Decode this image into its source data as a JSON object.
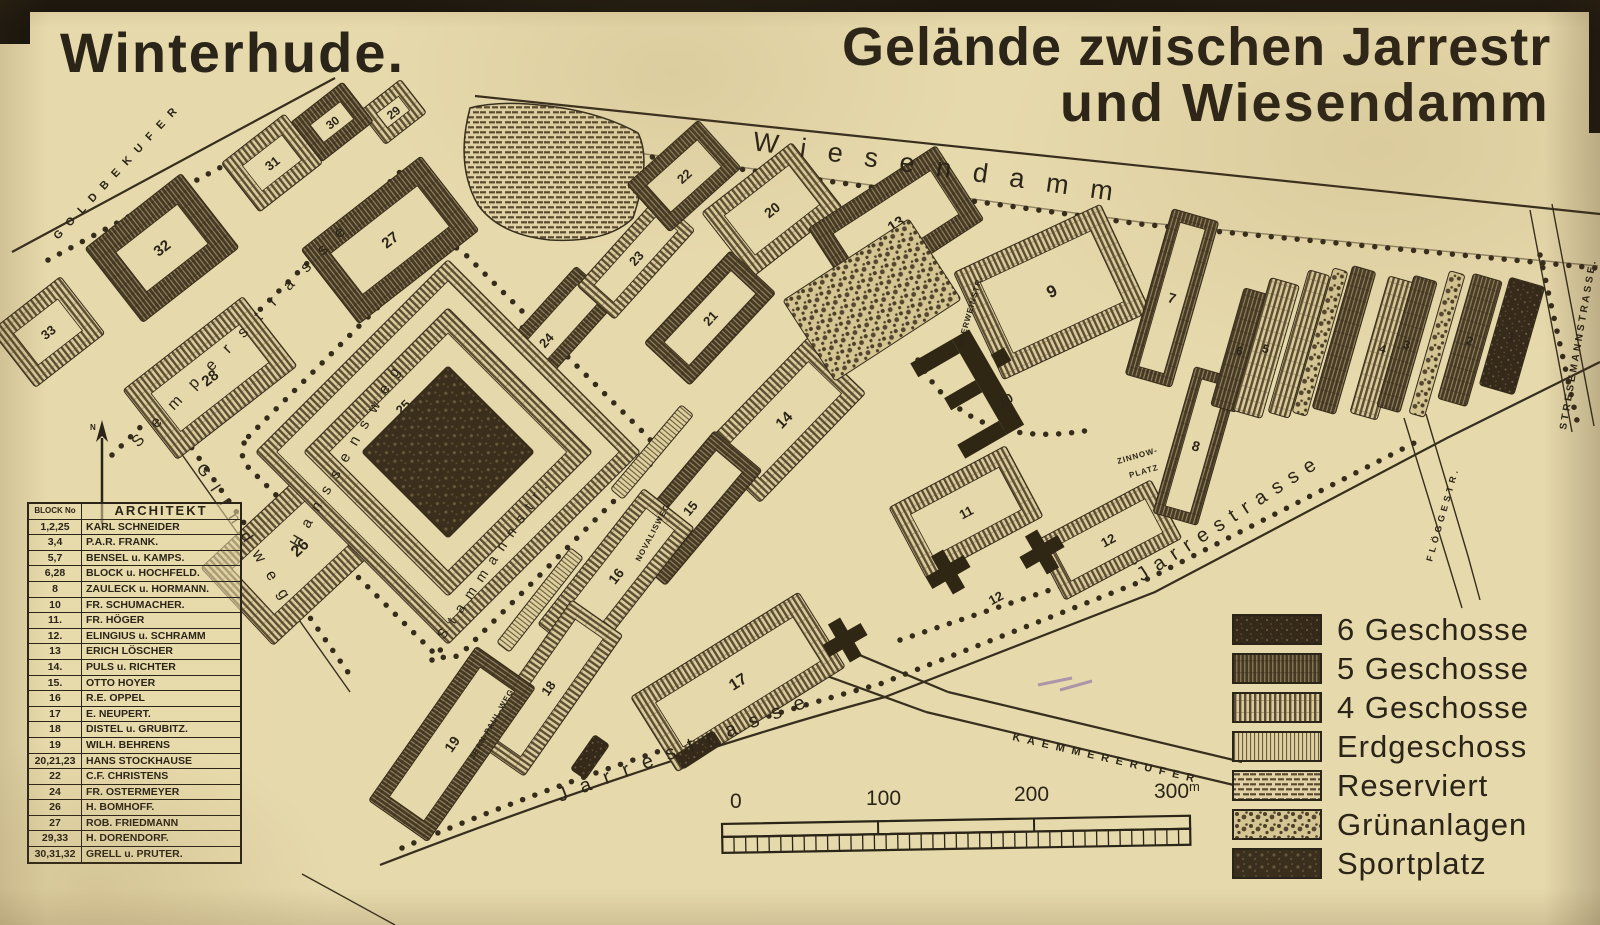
{
  "titles": {
    "left": "Winterhude.",
    "right_line1": "Gelände zwischen Jarrestr",
    "right_line2": "und Wiesendamm"
  },
  "architects": {
    "header_block": "BLOCK No",
    "header_architekt": "ARCHITEKT",
    "rows": [
      [
        "1,2,25",
        "KARL SCHNEIDER"
      ],
      [
        "3,4",
        "P.A.R. FRANK."
      ],
      [
        "5,7",
        "BENSEL u. KAMPS."
      ],
      [
        "6,28",
        "BLOCK u. HOCHFELD."
      ],
      [
        "8",
        "ZAULECK u. HORMANN."
      ],
      [
        "10",
        "FR. SCHUMACHER."
      ],
      [
        "11.",
        "FR. HÖGER"
      ],
      [
        "12.",
        "ELINGIUS u. SCHRAMM"
      ],
      [
        "13",
        "ERICH LÖSCHER"
      ],
      [
        "14.",
        "PULS u. RICHTER"
      ],
      [
        "15.",
        "OTTO HOYER"
      ],
      [
        "16",
        "R.E. OPPEL"
      ],
      [
        "17",
        "E. NEUPERT."
      ],
      [
        "18",
        "DISTEL u. GRUBITZ."
      ],
      [
        "19",
        "WILH. BEHRENS"
      ],
      [
        "20,21,23",
        "HANS STOCKHAUSE"
      ],
      [
        "22",
        "C.F. CHRISTENS"
      ],
      [
        "24",
        "FR. OSTERMEYER"
      ],
      [
        "26",
        "H. BOMHOFF."
      ],
      [
        "27",
        "ROB. FRIEDMANN"
      ],
      [
        "29,33",
        "H. DORENDORF."
      ],
      [
        "30,31,32",
        "GRELL u. PRUTER."
      ]
    ]
  },
  "legend": {
    "items": [
      {
        "label": "6 Geschosse",
        "pattern": "p6"
      },
      {
        "label": "5 Geschosse",
        "pattern": "p5"
      },
      {
        "label": "4 Geschosse",
        "pattern": "p4"
      },
      {
        "label": "Erdgeschoss",
        "pattern": "peg"
      },
      {
        "label": "Reserviert",
        "pattern": "pres"
      },
      {
        "label": "Grünanlagen",
        "pattern": "pgruen"
      },
      {
        "label": "Sportplatz",
        "pattern": "psport"
      }
    ]
  },
  "scale": {
    "labels": [
      "0",
      "100",
      "200",
      "300"
    ],
    "unit": "m"
  },
  "map": {
    "north_label": "N",
    "streets": {
      "wiesendamm": "Wiesendamm",
      "jarrestrasse": "Jarrestrasse",
      "semperstrasse": "Semperstrasse",
      "hanssensweg": "Hanssensweg",
      "glindweg": "Glindweg",
      "stammannstr": "Stammannstr.",
      "goldbekufer": "GOLDBEKUFER",
      "kaemmererufer": "KAEMMERERUFER",
      "stresemannstrasse": "STRESEMANNSTRASSE.",
      "floeggestr": "FLÖGGESTR.",
      "meerweinstr": "MEERWEINSTR.",
      "novalisweg": "NOVALISWEG",
      "jeanpaulweg": "JEAN-PAUL-WEG",
      "zinnowplatz_line1": "ZINNOW-",
      "zinnowplatz_line2": "PLATZ"
    },
    "blocks": [
      {
        "n": "29",
        "x": 393,
        "y": 112,
        "w": 52,
        "h": 42,
        "rot": -38,
        "pat": "p4",
        "band": 12,
        "fs": 12
      },
      {
        "n": "30",
        "x": 332,
        "y": 122,
        "w": 66,
        "h": 50,
        "rot": -38,
        "pat": "p5",
        "band": 14,
        "fs": 12
      },
      {
        "n": "31",
        "x": 272,
        "y": 163,
        "w": 80,
        "h": 62,
        "rot": -38,
        "pat": "p4",
        "band": 15,
        "fs": 13
      },
      {
        "n": "32",
        "x": 162,
        "y": 248,
        "w": 122,
        "h": 94,
        "rot": -38,
        "pat": "p5",
        "band": 22,
        "fs": 15
      },
      {
        "n": "33",
        "x": 48,
        "y": 332,
        "w": 88,
        "h": 72,
        "rot": -38,
        "pat": "p4",
        "band": 16,
        "fs": 13
      },
      {
        "n": "28",
        "x": 210,
        "y": 378,
        "w": 152,
        "h": 88,
        "rot": -38,
        "pat": "p4",
        "band": 20,
        "fs": 15
      },
      {
        "n": "27",
        "x": 390,
        "y": 240,
        "w": 152,
        "h": 94,
        "rot": -38,
        "pat": "p5",
        "band": 21,
        "fs": 15
      },
      {
        "n": "26",
        "x": 300,
        "y": 548,
        "w": 172,
        "h": 106,
        "rot": -43,
        "pat": "p4",
        "band": 22,
        "fs": 16
      },
      {
        "n": "24",
        "x": 546,
        "y": 340,
        "w": 150,
        "h": 54,
        "rot": -48,
        "pat": "p5",
        "band": 13,
        "fs": 13
      },
      {
        "n": "",
        "x": 448,
        "y": 452,
        "w": 272,
        "h": 272,
        "rot": -45,
        "pat": "p4",
        "band": 15
      },
      {
        "n": "25",
        "x": 448,
        "y": 452,
        "w": 204,
        "h": 204,
        "rot": -45,
        "pat": "p4",
        "band": 18,
        "fs": 13,
        "ny": -64
      },
      {
        "n": "",
        "x": 448,
        "y": 452,
        "w": 122,
        "h": 122,
        "rot": -45,
        "pat": "psport",
        "band": 0
      },
      {
        "n": "23",
        "x": 636,
        "y": 258,
        "w": 120,
        "h": 50,
        "rot": -48,
        "pat": "p4",
        "band": 12,
        "fs": 13
      },
      {
        "n": "22",
        "x": 684,
        "y": 176,
        "w": 96,
        "h": 64,
        "rot": -42,
        "pat": "p5",
        "band": 14,
        "fs": 13
      },
      {
        "n": "20",
        "x": 772,
        "y": 210,
        "w": 114,
        "h": 82,
        "rot": -38,
        "pat": "p4",
        "band": 16,
        "fs": 14
      },
      {
        "n": "21",
        "x": 710,
        "y": 318,
        "w": 126,
        "h": 62,
        "rot": -47,
        "pat": "p5",
        "band": 14,
        "fs": 13
      },
      {
        "n": "13",
        "x": 896,
        "y": 224,
        "w": 152,
        "h": 88,
        "rot": -33,
        "pat": "p5",
        "band": 18,
        "fs": 15
      },
      {
        "n": "14",
        "x": 784,
        "y": 420,
        "w": 152,
        "h": 80,
        "rot": -46,
        "pat": "p4",
        "band": 17,
        "fs": 15
      },
      {
        "n": "15",
        "x": 690,
        "y": 508,
        "w": 150,
        "h": 62,
        "rot": -50,
        "pat": "p5",
        "band": 14,
        "fs": 13
      },
      {
        "n": "16",
        "x": 616,
        "y": 576,
        "w": 172,
        "h": 64,
        "rot": -52,
        "pat": "p4",
        "band": 14,
        "fs": 14
      },
      {
        "n": "18",
        "x": 548,
        "y": 688,
        "w": 172,
        "h": 62,
        "rot": -55,
        "pat": "p4",
        "band": 14,
        "fs": 13
      },
      {
        "n": "19",
        "x": 452,
        "y": 744,
        "w": 188,
        "h": 72,
        "rot": -55,
        "pat": "p5",
        "band": 15,
        "fs": 14
      },
      {
        "n": "17",
        "x": 738,
        "y": 682,
        "w": 198,
        "h": 88,
        "rot": -32,
        "pat": "p4",
        "band": 18,
        "fs": 16
      },
      {
        "n": "9",
        "x": 1052,
        "y": 292,
        "w": 162,
        "h": 118,
        "rot": -25,
        "pat": "p4",
        "band": 20,
        "fs": 17
      },
      {
        "n": "11",
        "x": 966,
        "y": 512,
        "w": 132,
        "h": 80,
        "rot": -28,
        "pat": "p4",
        "band": 16,
        "fs": 13
      },
      {
        "n": "12",
        "x": 1108,
        "y": 540,
        "w": 132,
        "h": 66,
        "rot": -28,
        "pat": "p4",
        "band": 14,
        "fs": 13
      },
      {
        "n": "7",
        "x": 1172,
        "y": 298,
        "w": 48,
        "h": 172,
        "rot": 16,
        "pat": "p5",
        "band": 11,
        "fs": 14
      },
      {
        "n": "8",
        "x": 1196,
        "y": 446,
        "w": 46,
        "h": 152,
        "rot": 16,
        "pat": "p5",
        "band": 10,
        "fs": 14
      },
      {
        "n": "6",
        "x": 1240,
        "y": 350,
        "w": 26,
        "h": 122,
        "rot": 16,
        "pat": "p5",
        "band": 0,
        "fs": 12
      },
      {
        "n": "5",
        "x": 1266,
        "y": 348,
        "w": 30,
        "h": 138,
        "rot": 16,
        "pat": "p4",
        "band": 0,
        "fs": 12
      },
      {
        "n": "",
        "x": 1299,
        "y": 344,
        "w": 22,
        "h": 148,
        "rot": 16,
        "pat": "p4",
        "band": 0
      },
      {
        "n": "",
        "x": 1320,
        "y": 342,
        "w": 15,
        "h": 150,
        "rot": 16,
        "pat": "pgruen",
        "band": 0
      },
      {
        "n": "",
        "x": 1344,
        "y": 340,
        "w": 24,
        "h": 148,
        "rot": 16,
        "pat": "p5",
        "band": 0
      },
      {
        "n": "4",
        "x": 1383,
        "y": 348,
        "w": 28,
        "h": 142,
        "rot": 16,
        "pat": "p4",
        "band": 0,
        "fs": 12
      },
      {
        "n": "3",
        "x": 1407,
        "y": 344,
        "w": 24,
        "h": 136,
        "rot": 16,
        "pat": "p5",
        "band": 0,
        "fs": 12
      },
      {
        "n": "",
        "x": 1437,
        "y": 344,
        "w": 16,
        "h": 148,
        "rot": 16,
        "pat": "pgruen",
        "band": 0
      },
      {
        "n": "2",
        "x": 1470,
        "y": 340,
        "w": 30,
        "h": 130,
        "rot": 16,
        "pat": "p5",
        "band": 0,
        "fs": 12
      },
      {
        "n": "1",
        "x": 1512,
        "y": 336,
        "w": 36,
        "h": 112,
        "rot": 16,
        "pat": "p6",
        "band": 0,
        "fs": 12
      },
      {
        "n": "",
        "x": 872,
        "y": 300,
        "w": 150,
        "h": 96,
        "rot": -33,
        "pat": "pgruen",
        "band": 0
      },
      {
        "n": "",
        "x": 652,
        "y": 452,
        "w": 110,
        "h": 16,
        "rot": -50,
        "pat": "peg",
        "band": 0
      },
      {
        "n": "",
        "x": 540,
        "y": 600,
        "w": 120,
        "h": 16,
        "rot": -52,
        "pat": "peg",
        "band": 0
      },
      {
        "n": "",
        "x": 590,
        "y": 757,
        "w": 42,
        "h": 18,
        "rot": -55,
        "pat": "p6",
        "band": 0
      },
      {
        "n": "",
        "x": 698,
        "y": 750,
        "w": 46,
        "h": 16,
        "rot": -33,
        "pat": "p6",
        "band": 0
      }
    ],
    "labels": [
      {
        "t": "12",
        "x": 998,
        "y": 602,
        "rot": -28
      },
      {
        "t": "10",
        "x": 1008,
        "y": 404,
        "rot": -30
      }
    ]
  }
}
